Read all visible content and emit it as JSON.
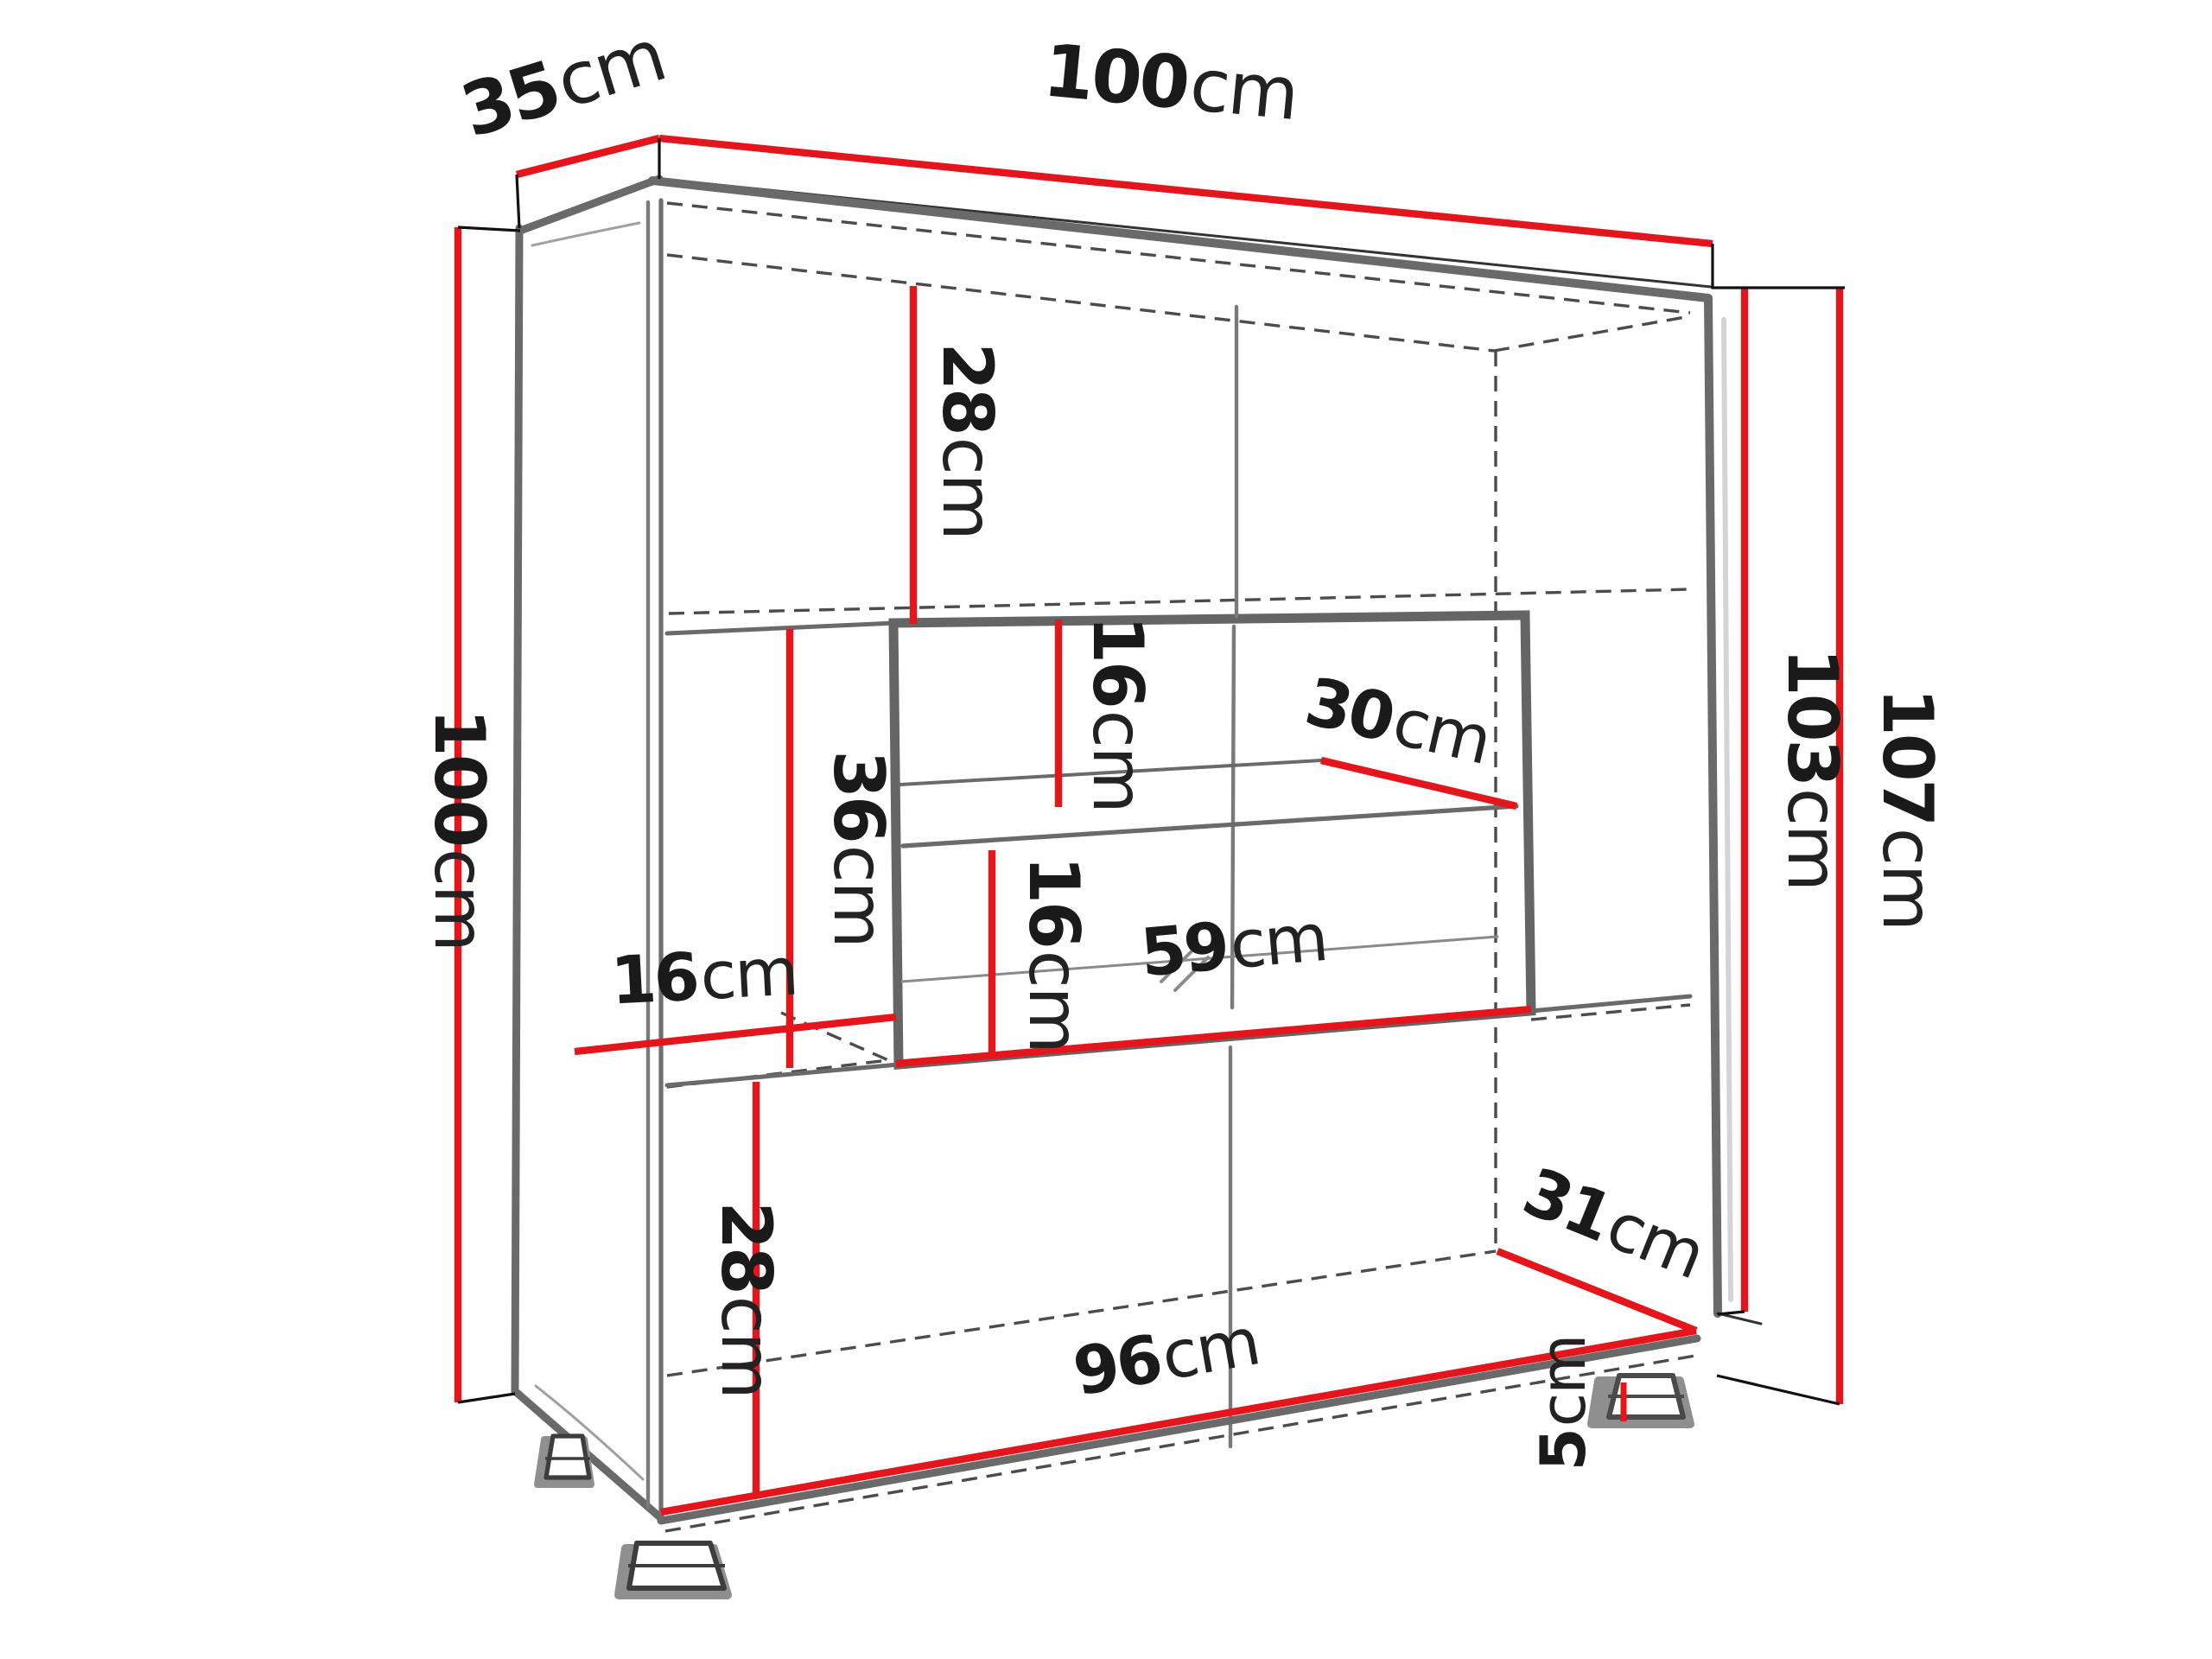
{
  "diagram": {
    "type": "furniture-dimension-drawing",
    "subject": "display cabinet with glass showcase, three sections and feet",
    "unit": "cm",
    "colors": {
      "dimension_line": "#e4151b",
      "outline": "#6a6a6a",
      "hidden_line": "#4c4c4c",
      "label_text": "#1a1a1a",
      "background": "#ffffff"
    },
    "dimensions": {
      "depth_top": {
        "value": "35",
        "unit": "cm",
        "meaning": "cabinet depth (top left edge)"
      },
      "width_top": {
        "value": "100",
        "unit": "cm",
        "meaning": "cabinet width (top edge)"
      },
      "height_left": {
        "value": "100",
        "unit": "cm",
        "meaning": "left side height"
      },
      "top_compartment": {
        "value": "28",
        "unit": "cm",
        "meaning": "top compartment interior height"
      },
      "showcase_upper_gap": {
        "value": "16",
        "unit": "cm",
        "meaning": "showcase space above glass shelf"
      },
      "glass_shelf_depth": {
        "value": "30",
        "unit": "cm",
        "meaning": "glass shelf depth"
      },
      "middle_left_height": {
        "value": "36",
        "unit": "cm",
        "meaning": "middle open section interior height"
      },
      "left_gap_width": {
        "value": "16",
        "unit": "cm",
        "meaning": "gap between left wall and showcase"
      },
      "showcase_lower_gap": {
        "value": "16",
        "unit": "cm",
        "meaning": "showcase space below glass shelf"
      },
      "showcase_width": {
        "value": "59",
        "unit": "cm",
        "meaning": "showcase interior width"
      },
      "bottom_compartment": {
        "value": "28",
        "unit": "cm",
        "meaning": "bottom compartment interior height"
      },
      "bottom_width": {
        "value": "96",
        "unit": "cm",
        "meaning": "interior width at bottom"
      },
      "bottom_depth": {
        "value": "31",
        "unit": "cm",
        "meaning": "interior depth at bottom"
      },
      "foot_height": {
        "value": "5",
        "unit": "cm",
        "meaning": "foot height"
      },
      "carcass_height_right": {
        "value": "103",
        "unit": "cm",
        "meaning": "carcass height without feet"
      },
      "total_height_right": {
        "value": "107",
        "unit": "cm",
        "meaning": "total height with feet"
      }
    }
  }
}
